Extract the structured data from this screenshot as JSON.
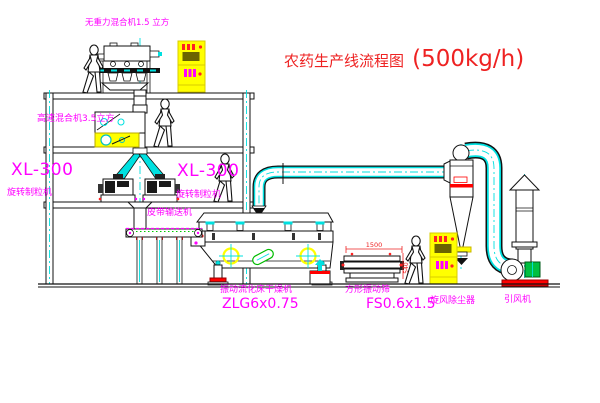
{
  "title": {
    "cn": "农药生产线流程图",
    "capacity": "(500kg/h)"
  },
  "equipment": {
    "top_mixer": {
      "label": "无重力混合机1.5 立方"
    },
    "high_speed_mixer": {
      "label": "高速混合机3.5立方"
    },
    "granulator_left": {
      "model": "XL-300",
      "name": "旋转制粒机"
    },
    "granulator_right": {
      "model": "XL-300",
      "name": "旋转制粒机"
    },
    "belt_conveyor": {
      "label": "皮带输送机"
    },
    "fluid_bed_dryer": {
      "name": "振动流化床干燥机",
      "model": "ZLG6x0.75"
    },
    "vibrating_sieve": {
      "name": "方形振动筛",
      "model": "FS0.6x1.5",
      "dim_width": "1500",
      "dim_height": "540"
    },
    "cyclone": {
      "name": "旋风除尘器"
    },
    "induced_fan": {
      "name": "引风机"
    }
  },
  "colors": {
    "line": "#111111",
    "label": "#ff00ff",
    "title": "#ee2222",
    "pipe_center": "#00e0e0",
    "cabinet": "#ffff00",
    "alert": "#ff0000",
    "motor": "#00c040",
    "target_ring": "#ffff00"
  },
  "icons": {
    "worker": "person-silhouette",
    "target": "crosshair-circle-symbol",
    "cabinet": "control-cabinet"
  }
}
